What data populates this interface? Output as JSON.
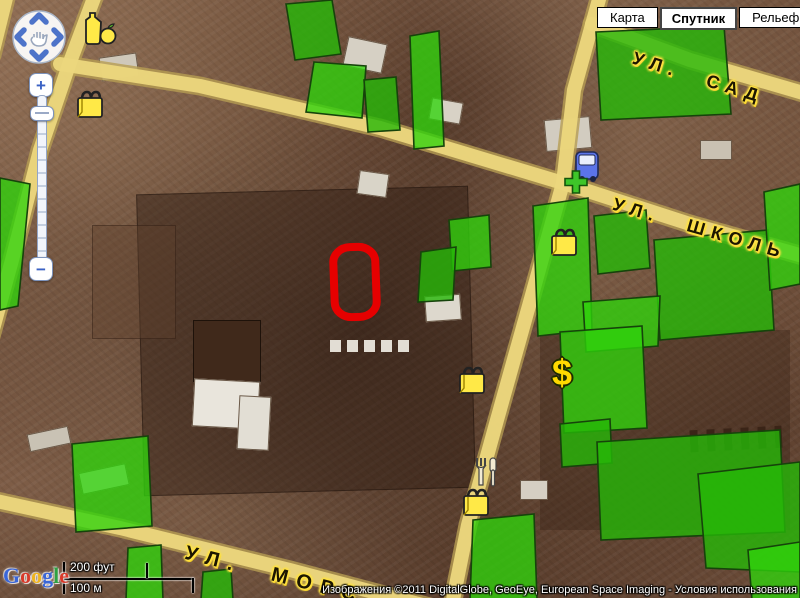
{
  "header": {
    "map_type_buttons": [
      {
        "label": "Карта",
        "selected": false
      },
      {
        "label": "Спутник",
        "selected": true
      },
      {
        "label": "Рельеф",
        "selected": false
      }
    ]
  },
  "zoom_control": {
    "zoom_in": "+",
    "zoom_out": "−"
  },
  "street_labels": [
    "УЛ. САД",
    "УЛ. ШКОЛЬ",
    "УЛ. МОРС"
  ],
  "scale_bar": {
    "imperial": "200 фут",
    "metric": "100 м"
  },
  "google_logo": {
    "letters": [
      "G",
      "o",
      "o",
      "g",
      "l",
      "e"
    ],
    "colors": [
      "#3a66d8",
      "#d83a2a",
      "#efb41f",
      "#3a66d8",
      "#2fa143",
      "#d83a2a"
    ]
  },
  "attribution": {
    "imagery": "Изображения ©2011 DigitalGlobe, GeoEye, European Space Imaging",
    "separator": " - ",
    "terms_link": "Условия использования"
  },
  "poi_icons": [
    {
      "name": "grocery-store-icon"
    },
    {
      "name": "shopping-bag-icon"
    },
    {
      "name": "transit-station-icon"
    },
    {
      "name": "pharmacy-cross-icon"
    },
    {
      "name": "shopping-bag-icon"
    },
    {
      "name": "bank-icon",
      "symbol": "$"
    },
    {
      "name": "shopping-bag-icon"
    },
    {
      "name": "restaurant-icon"
    },
    {
      "name": "shopping-bag-icon"
    }
  ],
  "colors": {
    "highlight_green": "#2fd40c",
    "selection_red": "#e60000",
    "road_yellow": "#ecd77d"
  }
}
